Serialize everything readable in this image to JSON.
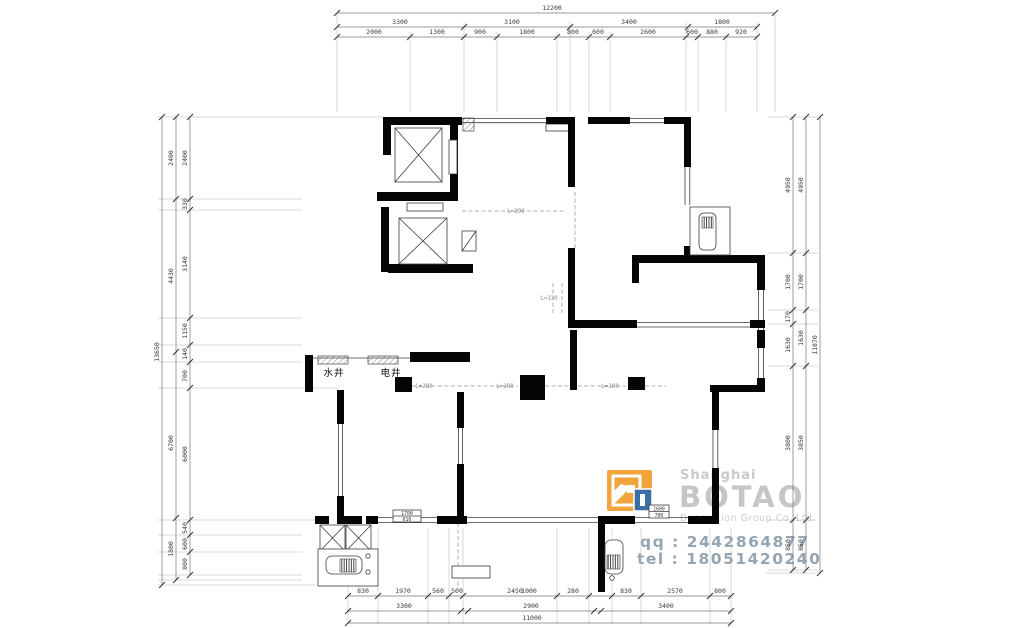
{
  "plan": {
    "water_shaft": "水井",
    "electric_shaft": "电井",
    "beam_labels": {
      "top": "L=290",
      "middle": "L=330",
      "a": "L=280",
      "b": "L=280",
      "c": "L=280"
    },
    "tag_left": {
      "line1": "1700",
      "line2": "610"
    },
    "tag_right": {
      "line1": "1600",
      "line2": "700"
    }
  },
  "dimensions": {
    "top": {
      "total": "12200",
      "row2": [
        "3300",
        "3100",
        "3400",
        "1800"
      ],
      "row3": [
        "2000",
        "1300",
        "900",
        "1800",
        "800",
        "600",
        "2600",
        "600",
        "880",
        "920"
      ]
    },
    "bottom": {
      "row1": [
        "830",
        "1970",
        "560",
        "500",
        "2450",
        "1000",
        "280",
        "830",
        "2570",
        "800"
      ],
      "row2": [
        "3300",
        "2900",
        "3400"
      ],
      "total": "11000"
    },
    "left": {
      "total": "13650",
      "outer": [
        "2400",
        "4430",
        "6700",
        "1800"
      ],
      "inner": [
        "2400",
        "330",
        "3140",
        "1150",
        "140",
        "700",
        "6000",
        "540",
        "600",
        "800"
      ]
    },
    "right": {
      "total": "11870",
      "chain1": [
        "4950",
        "1700",
        "170",
        "1630",
        "3800",
        "850"
      ],
      "chain2": [
        "4950",
        "1700",
        "1630",
        "3850",
        "850"
      ]
    }
  },
  "watermark": {
    "shanghai": "Shanghai",
    "brand": "BOTAO",
    "subtitle": "Decoration Group Co.,Ltd.",
    "qq": "qq : 2442864877",
    "tel": "tel : 18051420240",
    "colors": {
      "gray": "#c9c9c9",
      "contact": "#96a5b2",
      "logo_orange": "#f1a43c",
      "logo_blue": "#3a6ea5"
    }
  }
}
